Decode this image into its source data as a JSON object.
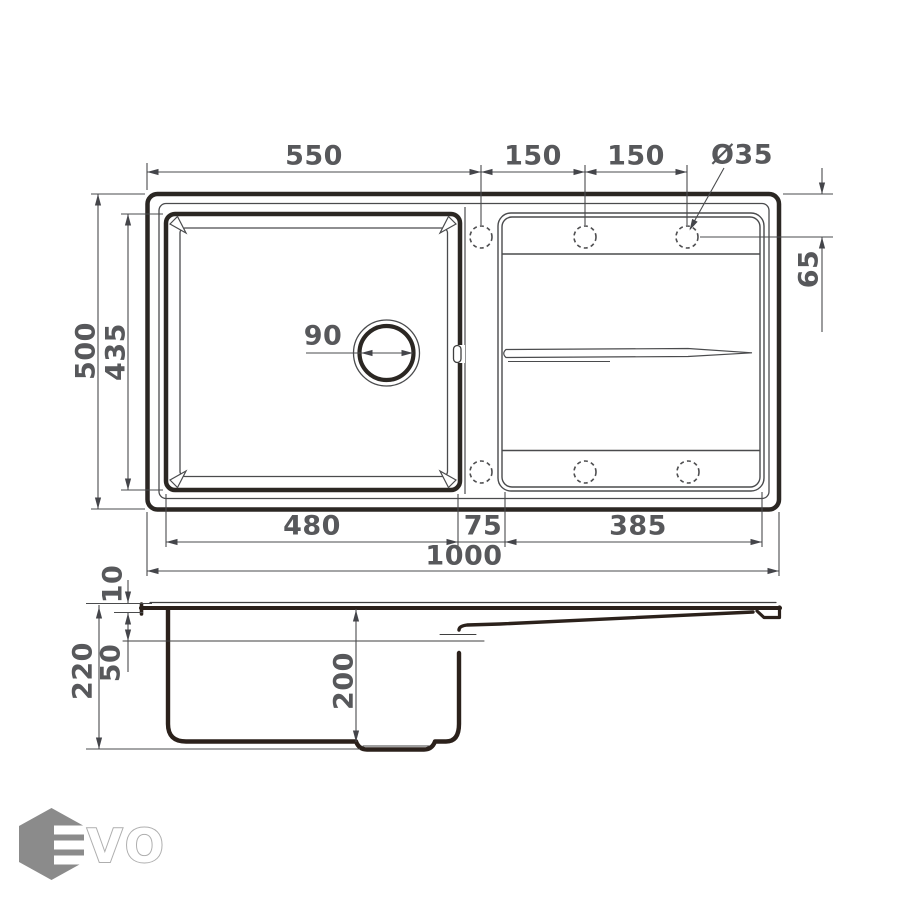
{
  "drawing": {
    "subject": "kitchen-sink-technical-drawing",
    "colors": {
      "background": "#ffffff",
      "thick_line": "#2b2723",
      "thin_line": "#4a4b4d",
      "profile_line": "#2b211b",
      "label_gray": "#57585b",
      "logo_gray": "#8b8b8b",
      "logo_outline": "#aeaeae"
    },
    "top_view": {
      "dim_labels": {
        "left_to_first_hole": "550",
        "hole_spacing_1": "150",
        "hole_spacing_2": "150",
        "hole_diameter": "Ø35",
        "hole_offset_from_edge": "65",
        "overall_depth": "500",
        "bowl_inner_depth": "435",
        "drain_diameter": "90",
        "bowl_width": "480",
        "divider_width": "75",
        "drainboard_width": "385",
        "overall_width": "1000"
      },
      "faucet_hole_count": 6,
      "drain_count": 1
    },
    "side_view": {
      "dim_labels": {
        "rim_height": "10",
        "overall_height": "220",
        "upper_depth": "50",
        "bowl_depth": "200"
      }
    },
    "logo": {
      "brand": "EVO",
      "hexagon_letter": "E",
      "wordmark_letters": "VO"
    }
  }
}
